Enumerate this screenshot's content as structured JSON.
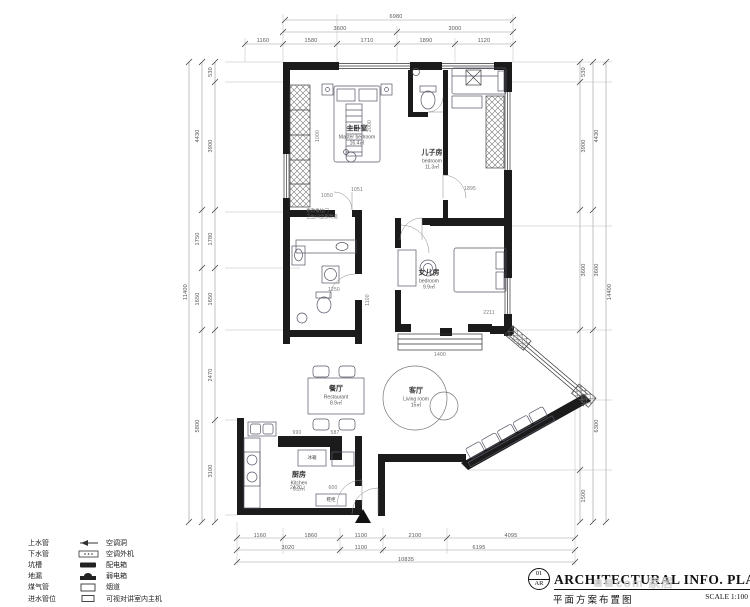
{
  "title_block": {
    "sheet_no": "01",
    "discipline": "AR",
    "title_en": "ARCHITECTURAL  INFO.  PLAN",
    "title_cn": "平面方案布置图",
    "scale": "SCALE 1:100"
  },
  "watermark": {
    "text": "com 家居"
  },
  "legend": {
    "rows": [
      {
        "left": "上水管",
        "right": "空调洞"
      },
      {
        "left": "下水管",
        "right": "空调外机"
      },
      {
        "left": "坑槽",
        "right": "配电箱"
      },
      {
        "left": "地漏",
        "right": "弱电箱"
      },
      {
        "left": "煤气管",
        "right": "烟道"
      },
      {
        "left": "进水管位",
        "right": "可视对讲室内主机"
      }
    ]
  },
  "rooms": {
    "master": {
      "cn": "主卧室",
      "en": "Master bedroom",
      "area": "16.4㎡"
    },
    "son": {
      "cn": "儿子房",
      "en": "bedroom",
      "area": "11.3㎡"
    },
    "daughter": {
      "cn": "女儿房",
      "en": "bedroom",
      "area": "9.9㎡"
    },
    "living": {
      "cn": "客厅",
      "en": "Living room",
      "area": "15㎡"
    },
    "dining": {
      "cn": "餐厅",
      "en": "Restaurant",
      "area": "8.9㎡"
    },
    "kitchen": {
      "cn": "厨房",
      "en": "Kitchen",
      "area": "6.2㎡"
    }
  },
  "fixtures": {
    "fridge": "冰箱",
    "shoe_cabinet": "鞋柜"
  },
  "annotation": {
    "line1": "更改推拉门",
    "line2": "卫生间全部改造"
  },
  "dimensions": {
    "top": {
      "total": "6980",
      "row2": [
        "3600",
        "3000"
      ],
      "row3": [
        "1160",
        "1580",
        "1710",
        "1890",
        "1120"
      ]
    },
    "bottom": {
      "row1": [
        "1160",
        "1860",
        "1100",
        "2100",
        "4095"
      ],
      "row2": [
        "3020",
        "1100",
        "6195"
      ],
      "total": "10835"
    },
    "left": {
      "inner": [
        "530",
        "3900",
        "1780",
        "1650",
        "2470",
        "3100"
      ],
      "outer": [
        "4430",
        "1750",
        "1650",
        "5800"
      ],
      "total": "11400"
    },
    "right": {
      "inner": [
        "530",
        "3900",
        "3600",
        "4800",
        "1500"
      ],
      "mid": [
        "4430",
        "3600",
        "6300"
      ],
      "total": "14400"
    },
    "interior": [
      "1000",
      "2000",
      "1050",
      "1051",
      "1895",
      "1100",
      "1250",
      "1400",
      "2211",
      "990",
      "587",
      "2420",
      "600"
    ]
  }
}
